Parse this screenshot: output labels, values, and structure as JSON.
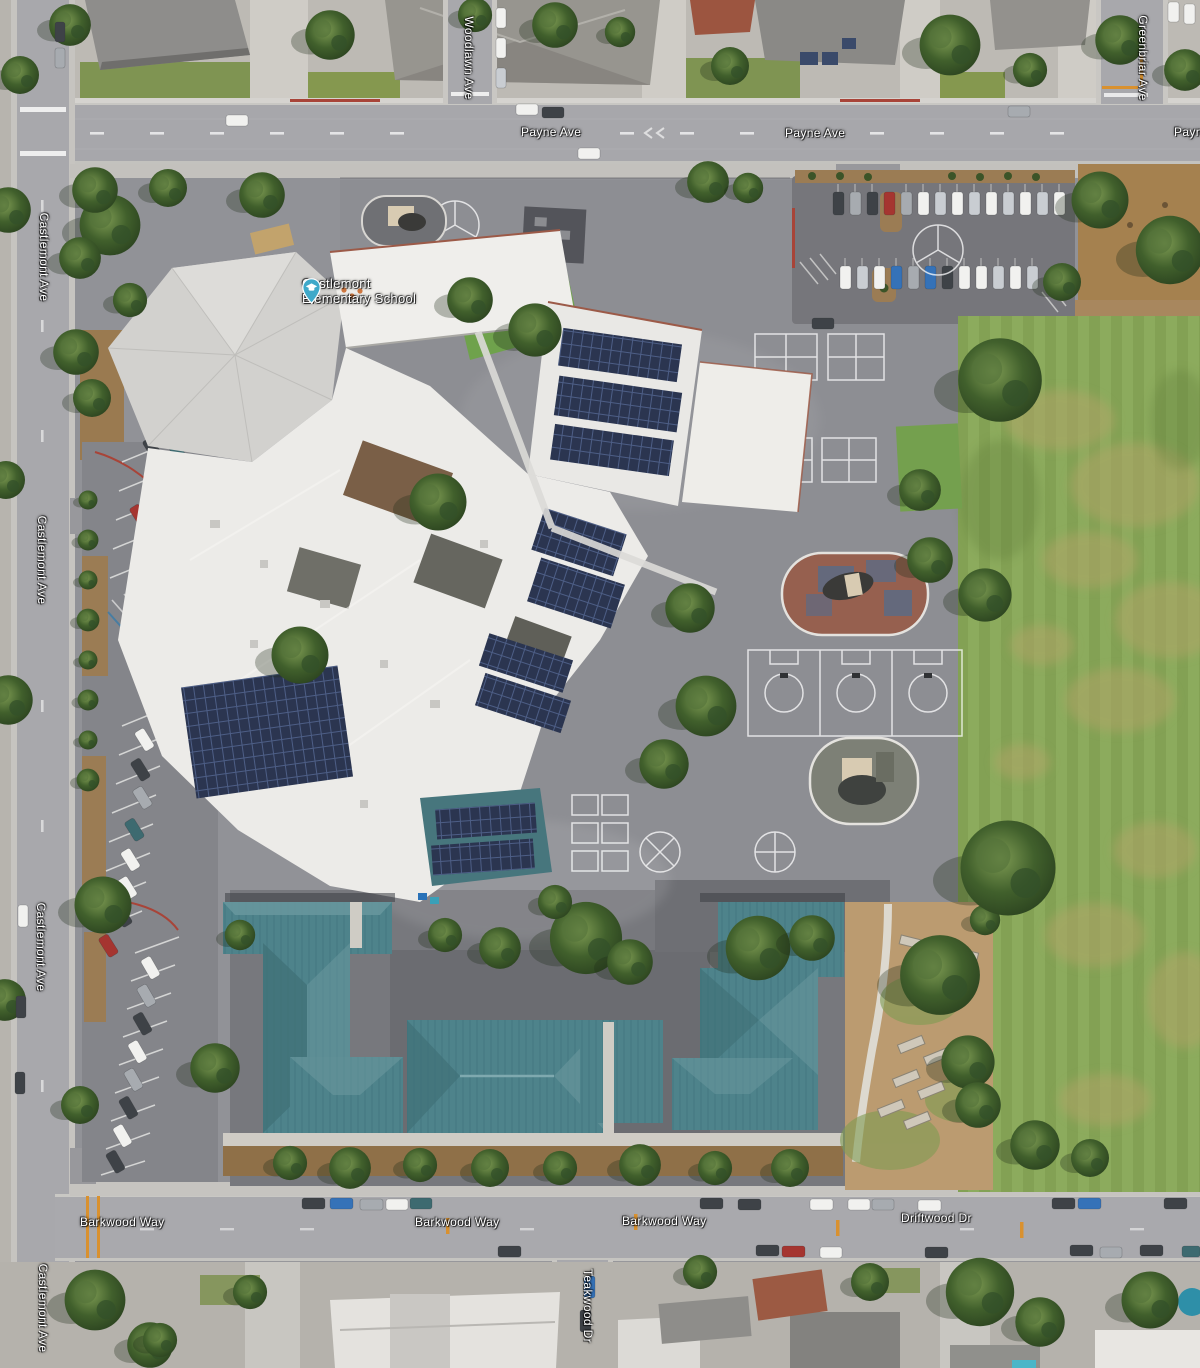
{
  "map": {
    "view_mode": "satellite"
  },
  "poi": {
    "school": {
      "name_line1": "Castlemont",
      "name_line2": "Elementary School",
      "icon": "graduation-cap-pin",
      "pin_color": "#3fa9c9"
    }
  },
  "streets": {
    "payne_ave": "Payne Ave",
    "castlemont_ave": "Castlemont Ave",
    "woodlawn_ave": "Woodlawn Ave",
    "greenbriar_ave": "Greenbriar Ave",
    "barkwood_way": "Barkwood Way",
    "driftwood_dr": "Driftwood Dr",
    "teakwood_dr": "Teakwood Dr"
  },
  "colors": {
    "road": "#a8a8ac",
    "campus_asphalt": "#8f9095",
    "grass_field": "#84a055",
    "roof_white": "#ecebe8",
    "roof_teal": "#4e838b",
    "solar_panel": "#2b3550",
    "label_text": "#ffffff"
  }
}
